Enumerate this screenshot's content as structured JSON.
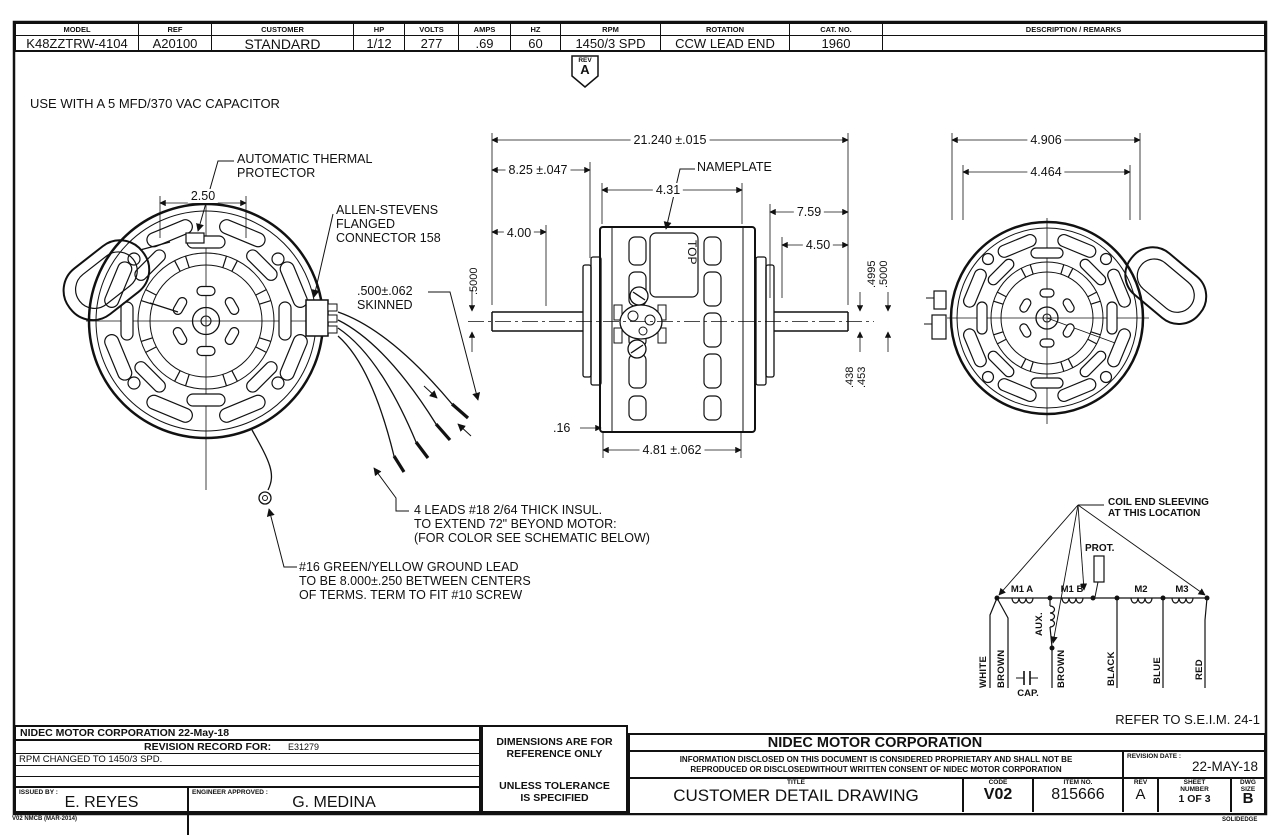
{
  "spec_table": {
    "model": {
      "label": "MODEL",
      "value": "K48ZZTRW-4104"
    },
    "ref": {
      "label": "REF",
      "value": "A20100"
    },
    "customer": {
      "label": "CUSTOMER",
      "value": "STANDARD"
    },
    "hp": {
      "label": "HP",
      "value": "1/12"
    },
    "volts": {
      "label": "VOLTS",
      "value": "277"
    },
    "amps": {
      "label": "AMPS",
      "value": ".69"
    },
    "hz": {
      "label": "HZ",
      "value": "60"
    },
    "rpm": {
      "label": "RPM",
      "value": "1450/3 SPD"
    },
    "rotation": {
      "label": "ROTATION",
      "value": "CCW LEAD END"
    },
    "cat_no": {
      "label": "CAT. NO.",
      "value": "1960"
    },
    "description": {
      "label": "DESCRIPTION / REMARKS",
      "value": ""
    }
  },
  "rev_flag": {
    "label": "REV",
    "value": "A"
  },
  "notes": {
    "capacitor": "USE WITH A 5 MFD/370 VAC CAPACITOR",
    "thermal_protector": "AUTOMATIC THERMAL\nPROTECTOR",
    "connector": "ALLEN-STEVENS\nFLANGED\nCONNECTOR 158",
    "skinned": ".500±.062\nSKINNED",
    "leads": "4 LEADS #18 2/64 THICK INSUL.\nTO EXTEND 72\" BEYOND MOTOR:\n(FOR COLOR SEE SCHEMATIC BELOW)",
    "ground": "#16 GREEN/YELLOW GROUND LEAD\nTO BE  8.000±.250 BETWEEN CENTERS\nOF TERMS. TERM TO FIT #10 SCREW",
    "nameplate": "NAMEPLATE",
    "top": "TOP",
    "refer": "REFER TO S.E.I.M. 24-1"
  },
  "dims": {
    "protector_width": "2.50",
    "overall_length": "21.240 ±.015",
    "shaft_ext_left": "8.25 ±.047",
    "body_length": "4.31",
    "shaft_right": "7.59",
    "shaft_left_flat": "4.00",
    "shaft_right_flat": "4.50",
    "shaft_dia_left": ".5000",
    "shaft_dia_right_min": ".4995",
    "shaft_dia_right_max": ".5000",
    "flat_min": ".438",
    "flat_max": ".453",
    "band_offset": ".16",
    "band_length": "4.81 ±.062",
    "end_od": "4.906",
    "bolt_circle": "4.464"
  },
  "schematic": {
    "sleeving": "COIL END SLEEVING\nAT THIS LOCATION",
    "prot": "PROT.",
    "m1a": "M1 A",
    "m1b": "M1 B",
    "m2": "M2",
    "m3": "M3",
    "aux": "AUX.",
    "cap": "CAP.",
    "white": "WHITE",
    "brown1": "BROWN",
    "brown2": "BROWN",
    "black": "BLACK",
    "blue": "BLUE",
    "red": "RED"
  },
  "revision_block": {
    "company_date": "NIDEC MOTOR CORPORATION 22-May-18",
    "record_label": "REVISION RECORD FOR:",
    "record_no": "E31279",
    "change": "RPM CHANGED TO 1450/3 SPD.",
    "issued_label": "ISSUED BY :",
    "issued_by": "E. REYES",
    "engineer_label": "ENGINEER APPROVED :",
    "engineer": "G. MEDINA",
    "form_code": "V02 NMCB (MAR-2014)"
  },
  "title_block": {
    "reference_note": "DIMENSIONS ARE FOR\nREFERENCE ONLY",
    "tolerance_note": "UNLESS TOLERANCE\nIS SPECIFIED",
    "company": "NIDEC MOTOR CORPORATION",
    "proprietary": "INFORMATION DISCLOSED ON THIS DOCUMENT IS CONSIDERED PROPRIETARY AND SHALL NOT BE\nREPRODUCED OR DISCLOSEDWITHOUT WRITTEN CONSENT OF NIDEC MOTOR CORPORATION",
    "revision_date_label": "REVISION DATE :",
    "revision_date": "22-MAY-18",
    "title_label": "TITLE",
    "title": "CUSTOMER  DETAIL  DRAWING",
    "code_label": "CODE",
    "code": "V02",
    "item_label": "ITEM NO.",
    "item_no": "815666",
    "rev_label": "REV",
    "rev": "A",
    "sheet_label": "SHEET\nNUMBER",
    "sheet": "1  OF  3",
    "size_label": "DWG\nSIZE",
    "size": "B",
    "cad_note": "SOLIDEDGE"
  }
}
